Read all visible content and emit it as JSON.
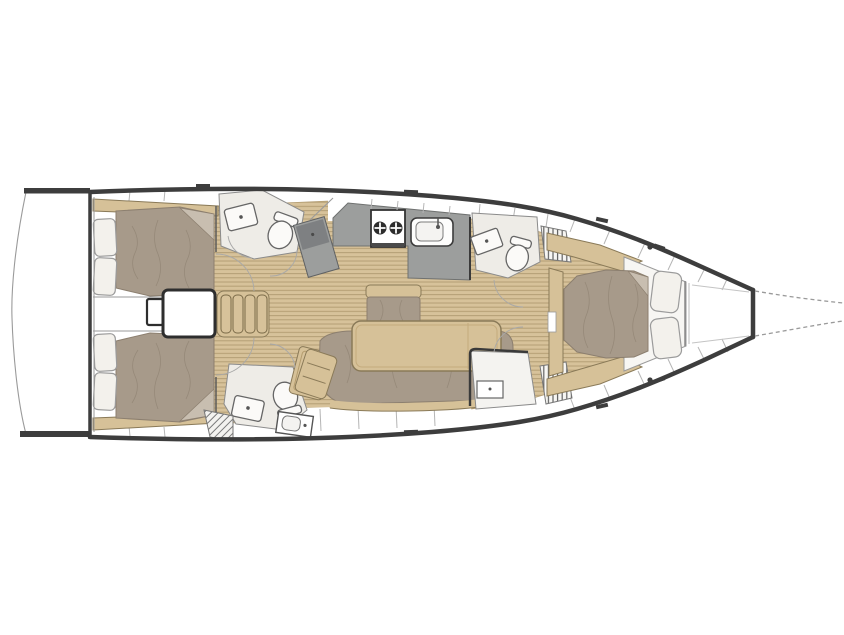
{
  "diagram": {
    "figure_type": "sailboat-interior-deck-plan-top-view-bow-right",
    "regions": [
      "swim-platform",
      "transom",
      "aft-cabin-port",
      "aft-cabin-starboard",
      "engine-compartment",
      "companionway-stairs",
      "aft-head-port",
      "aft-head-starboard",
      "nav-cabinet",
      "galley",
      "stove",
      "galley-sink",
      "salon-dinette",
      "salon-table",
      "salon-sofa",
      "salon-bench",
      "side-chair",
      "forward-head",
      "hanging-lockers",
      "starboard-locker-room",
      "forward-cabin",
      "island-bed",
      "anchor-locker",
      "bow-guide-lines"
    ],
    "palette": {
      "hull": "#3d3d3d",
      "teak": "#d7c29a",
      "teak_stripe": "#b49e74",
      "wood": "#d6c198",
      "wood_edge": "#8a7a58",
      "mattress": "#a79a8a",
      "mattress_edge": "#8c7f6f",
      "mattress_dark": "#938676",
      "mattress_fold": "#c8beb0",
      "counter": "#9c9e9d",
      "counter_dark": "#7e8082",
      "head_floor": "#eeece7",
      "pillow": "#f3f1ec",
      "deck_white": "#ffffff"
    }
  }
}
